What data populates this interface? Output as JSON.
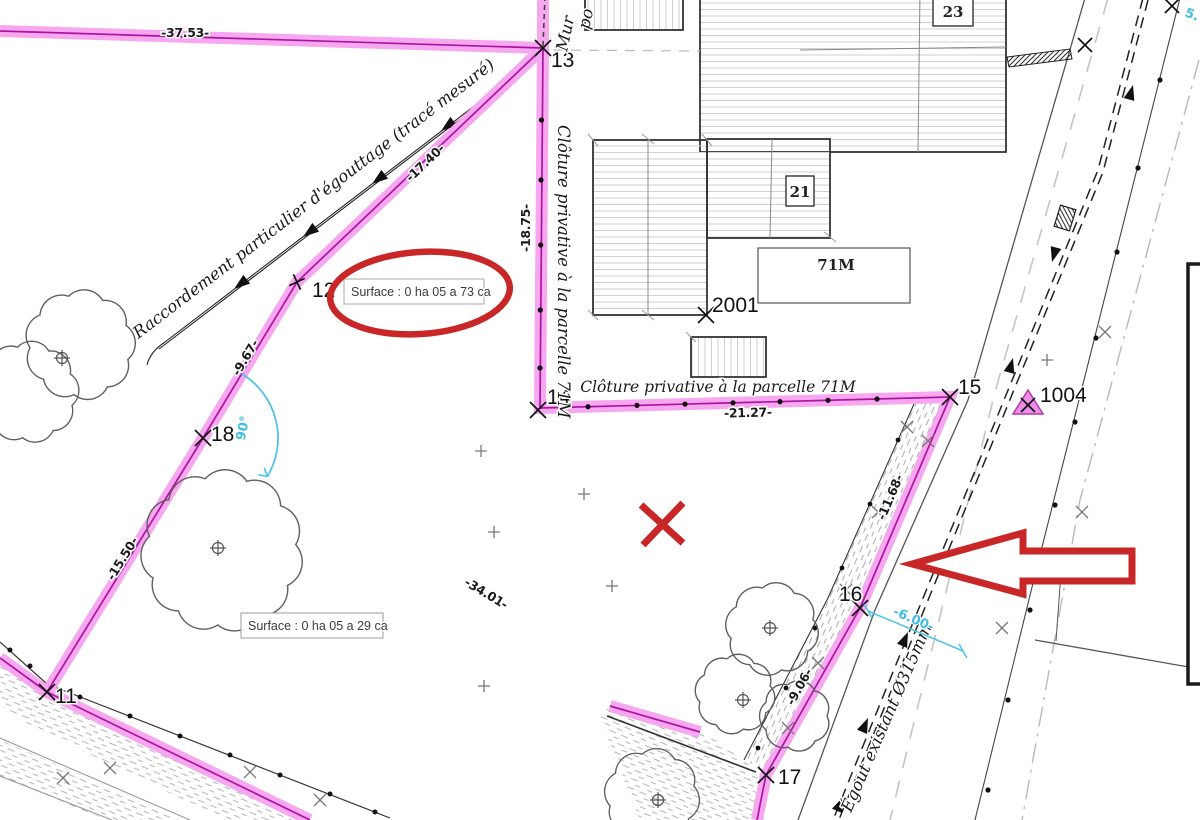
{
  "drawing_title": "Plan de mesurage - parcelle avec annotations",
  "points": {
    "11": "11",
    "12": "12",
    "13": "13",
    "14": "14",
    "15": "15",
    "16": "16",
    "17": "17",
    "18": "18",
    "2001": "2001",
    "1004": "1004"
  },
  "dimensions": {
    "top": "-37.53-",
    "seg_13_12": "-17.40-",
    "seg_12_18": "-9.67-",
    "seg_18_11": "-15.50-",
    "seg_18_17": "-34.01-",
    "seg_14_15": "-21.27-",
    "seg_13_14": "-18.75-",
    "seg_15_16": "-11.68-",
    "seg_16_17": "-9.06-",
    "front_width": "-6.00-",
    "angle": "90°",
    "corner_partial": "5."
  },
  "buildings": {
    "n23": "23",
    "n21": "21",
    "n71m": "71M"
  },
  "texts": {
    "raccordement": "Raccordement particulier d'égouttage (tracé mesuré)",
    "cloture_vertical": "Clôture privative à la parcelle 71M",
    "cloture_horizontal": "Clôture privative à la parcelle 71M",
    "egout": "Égout existant Ø315mm",
    "mur_fragment": "Mur",
    "po_fragment": "po",
    "surface_1": "Surface : 0 ha 05 a 73 ca",
    "surface_2": "Surface : 0 ha 05 a 29 ca"
  },
  "colors": {
    "parcel_band": "#f7a6f0",
    "parcel_line": "#ab16a0",
    "annotation_red": "#c92727",
    "dimension_cyan": "#3fbde4",
    "point_triangle": "#ec8fe4"
  }
}
